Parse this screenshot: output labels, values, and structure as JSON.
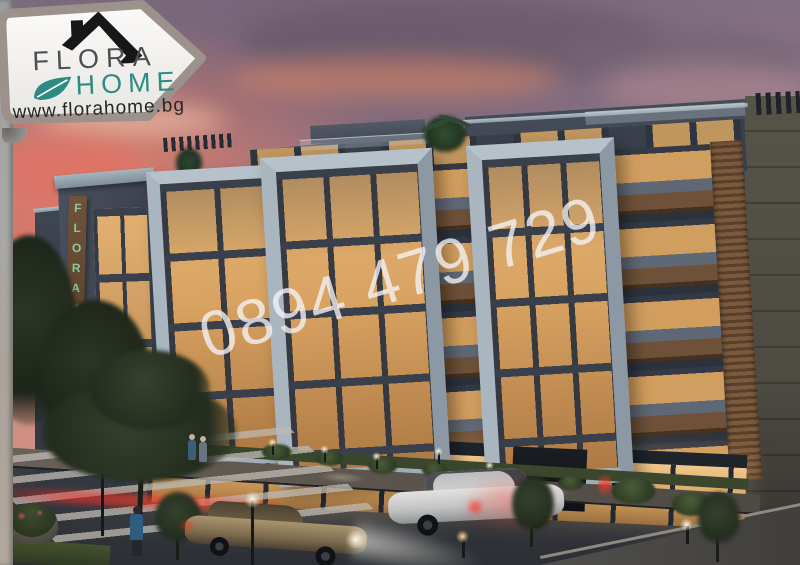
{
  "badge": {
    "brand_line1": "FLORA",
    "brand_line2": "HOME",
    "website": "www.florahome.bg",
    "accent_teal": "#2e8b83",
    "fill": "#f7f6f3",
    "border": "#9c918b",
    "icons": [
      "house-roof-icon",
      "leaf-icon"
    ]
  },
  "watermark": {
    "phone": "0894 479 729",
    "color": "#f3f3f7",
    "rotation_deg": -17
  },
  "building_sign": {
    "vertical_text_top": "FLORA",
    "vertical_text_bottom": "HOME",
    "top_color": "#8cc89b",
    "bottom_color": "#e9e9e7"
  },
  "palette": {
    "sky_dusk": "#8d7585",
    "cloud_pink": "#e4837a",
    "cloud_orange": "#e8916c",
    "facade_slate": "#3a414d",
    "portal_light": "#b6c1c9",
    "window_glow": "#e8bc7c",
    "wood_slat": "#7b5b3d",
    "road": "#34373c"
  }
}
